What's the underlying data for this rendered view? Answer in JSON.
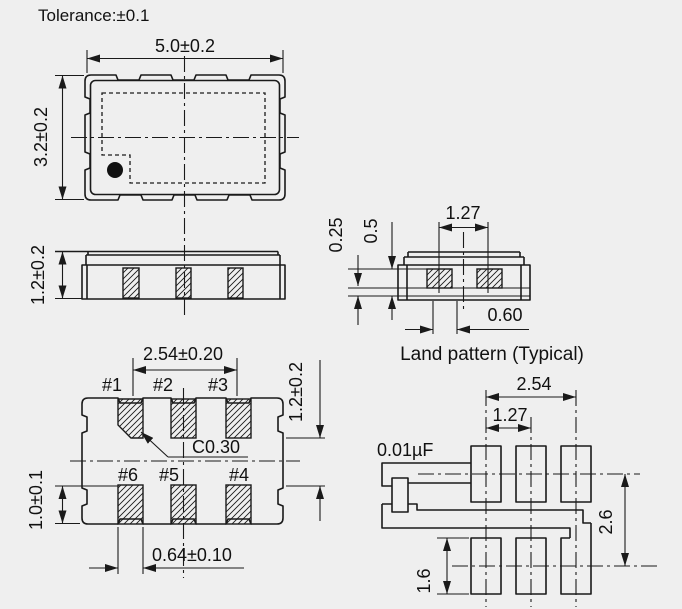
{
  "title": "Tolerance:±0.1",
  "colors": {
    "background": "#efefef",
    "line": "#1a1a1a",
    "text": "#111111"
  },
  "top_view": {
    "width_dim": "5.0±0.2",
    "height_dim": "3.2±0.2"
  },
  "side_view": {
    "height_dim": "1.2±0.2"
  },
  "land_side_view": {
    "pitch_dim": "1.27",
    "land_protrusion_dim": "0.25",
    "land_height_dim": "0.5",
    "gap_dim": "0.60",
    "caption": "Land pattern (Typical)"
  },
  "bottom_view": {
    "pitch_dim": "2.54±0.20",
    "row_gap_dim": "1.2±0.2",
    "pad_height_dim": "1.0±0.1",
    "pad_width_dim": "0.64±0.10",
    "chamfer_dim": "C0.30",
    "pins": [
      "#1",
      "#2",
      "#3",
      "#6",
      "#5",
      "#4"
    ]
  },
  "land_pattern": {
    "pitch_dim": "2.54",
    "half_pitch_dim": "1.27",
    "capacitor_label": "0.01µF",
    "row_spacing_dim": "2.6",
    "pad_height_dim": "1.6"
  }
}
